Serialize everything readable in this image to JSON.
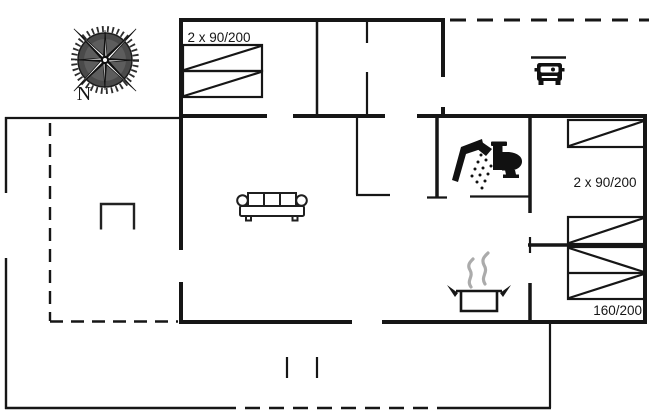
{
  "compass": {
    "north_label": "N"
  },
  "bedrooms": {
    "top_left": {
      "bed_size_label": "2 x 90/200"
    },
    "right_upper": {
      "bed_size_label": "2 x 90/200"
    },
    "right_lower": {
      "bed_size_label": "160/200"
    }
  },
  "icons": {
    "compass_rose": "compass-rose-icon",
    "carport_car": "car-icon",
    "shower": "shower-icon",
    "toilet": "toilet-icon",
    "sofa": "sofa-icon",
    "dining_table": "table-icon",
    "cooking_pot": "cooking-pot-icon",
    "steam": "steam-icon",
    "single_bed": "single-bed-icon",
    "double_bed": "double-bed-icon"
  },
  "colors": {
    "background": "#ffffff",
    "line": "#161616",
    "steam": "#ababab",
    "compass_disc": "#4a4a4a"
  }
}
